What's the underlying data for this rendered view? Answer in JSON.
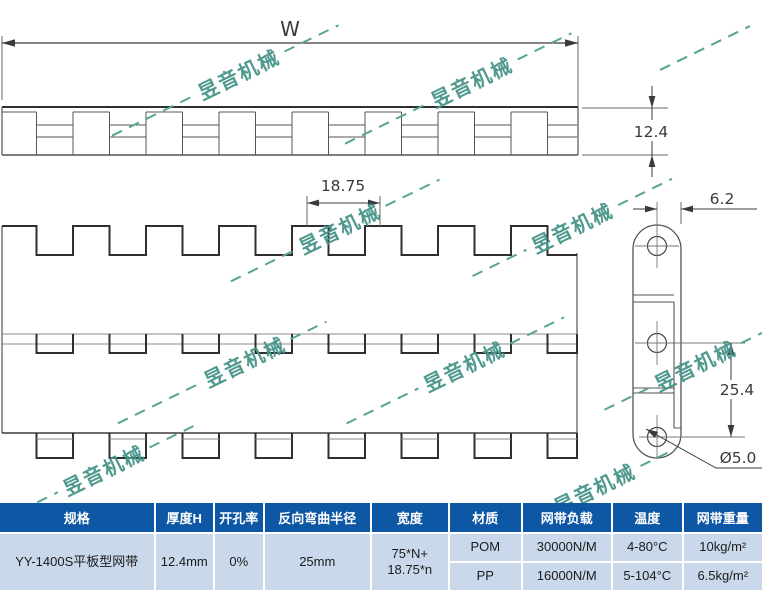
{
  "watermark": {
    "text": "昱音机械"
  },
  "drawing": {
    "dim_w": "W",
    "dim_thickness": "12.4",
    "dim_pitch": "18.75",
    "dim_plate_width": "6.2",
    "dim_hinge_spacing": "25.4",
    "dim_hole_dia": "Ø5.0"
  },
  "table": {
    "headers": [
      "规格",
      "厚度H",
      "开孔率",
      "反向弯曲半径",
      "宽度",
      "材质",
      "网带负载",
      "温度",
      "网带重量"
    ],
    "spec": "YY-1400S平板型网带",
    "thickness_h": "12.4mm",
    "open_ratio": "0%",
    "reverse_bend_radius": "25mm",
    "width_formula_line1": "75*N+",
    "width_formula_line2": "18.75*n",
    "materials": [
      {
        "material": "POM",
        "load": "30000N/M",
        "temperature": "4-80°C",
        "weight": "10kg/m²"
      },
      {
        "material": "PP",
        "load": "16000N/M",
        "temperature": "5-104°C",
        "weight": "6.5kg/m²"
      }
    ]
  },
  "colors": {
    "header_bg": "#0e57a5",
    "body_bg": "#c9d8ea",
    "watermark": "#47948a",
    "line": "#3a3a3a"
  }
}
